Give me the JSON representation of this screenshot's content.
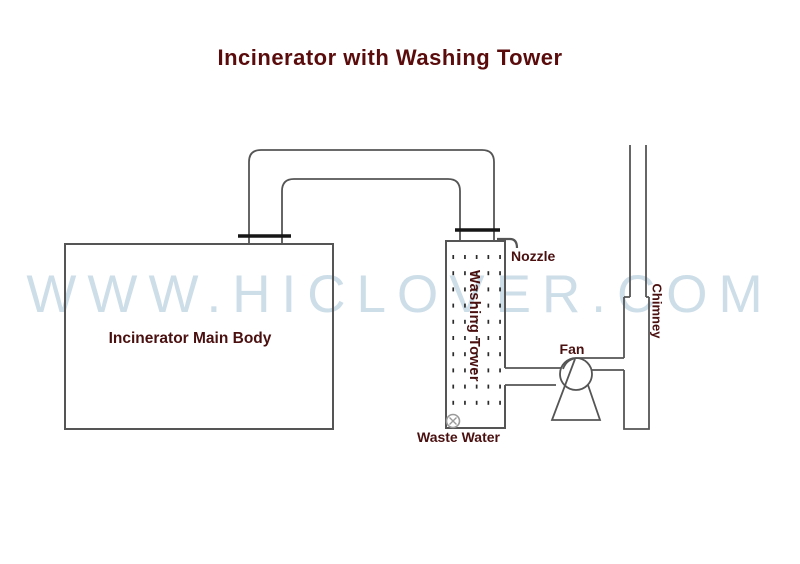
{
  "title": {
    "text": "Incinerator with Washing Tower"
  },
  "watermark": {
    "text": "WWW.HICLOVER.COM"
  },
  "labels": {
    "incinerator": "Incinerator Main Body",
    "washing_tower": "Washing Tower",
    "nozzle": "Nozzle",
    "fan": "Fan",
    "chimney": "Chimney",
    "waste_water": "Waste Water"
  },
  "colors": {
    "title": "#5a0c0c",
    "label": "#4a1010",
    "line": "#555555",
    "flange": "#161616",
    "watermark": "#cddee9",
    "dot": "#2a2a2a"
  },
  "tower_packing": {
    "columns": 5,
    "rows": 10
  }
}
